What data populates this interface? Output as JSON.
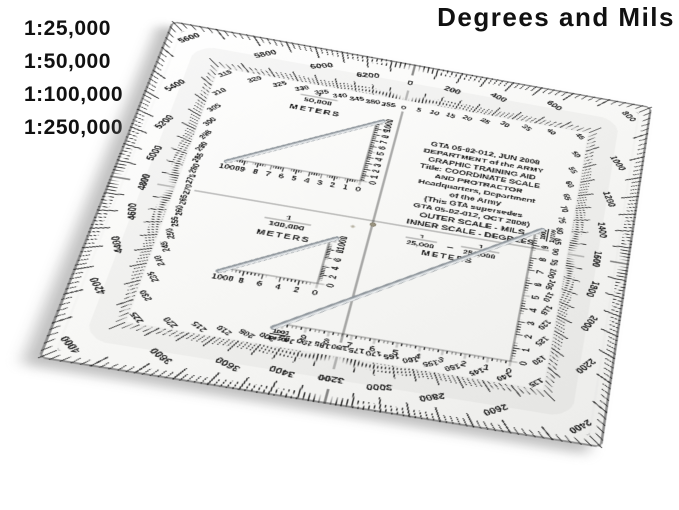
{
  "title": "Degrees and Mils",
  "ratios": {
    "items": [
      "1:25,000",
      "1:50,000",
      "1:100,000",
      "1:250,000"
    ]
  },
  "colors": {
    "ink": "#1a1a1a",
    "plastic_light": "#ffffff",
    "plastic_dark": "#ececea",
    "edge": "#8d8d8d",
    "rod_dark": "#8f969c",
    "rod_mid": "#c9ced2",
    "rod_light": "#f2f4f5",
    "hole": "#9a9480"
  },
  "protractor": {
    "info_block": {
      "lines": [
        "GTA 05-02-012, JUN 2008",
        "DEPARTMENT of the ARMY",
        "GRAPHIC TRAINING AID",
        "Title: COORDINATE SCALE",
        "AND PROTRACTOR",
        "Headquarters, Department",
        "of the Army",
        "(This GTA supersedes",
        "GTA 05-02-012, OCT 2008)"
      ]
    },
    "scale_note": {
      "line1": "OUTER SCALE - MILS",
      "line2": "INNER SCALE - DEGREES"
    },
    "center_fraction": {
      "num1": "1",
      "den1": "25,000",
      "dash": "–",
      "num2": "1",
      "den2": "250,000",
      "unit": "METERS"
    },
    "outer_scale": {
      "unit": "mils",
      "full_circle": 6400,
      "tick_step": 20,
      "major_step": 100,
      "label_step": 200,
      "labels": [
        "0",
        "200",
        "400",
        "600",
        "800",
        "1000",
        "1200",
        "1400",
        "1600",
        "1800",
        "2000",
        "2200",
        "2400",
        "2600",
        "2800",
        "3000",
        "3200",
        "3400",
        "3600",
        "3800",
        "4000",
        "4200",
        "4400",
        "4600",
        "4800",
        "5000",
        "5200",
        "5400",
        "5600",
        "5800",
        "6000",
        "6200"
      ]
    },
    "inner_scale": {
      "unit": "degrees",
      "full_circle": 360,
      "tick_step": 1,
      "label_step": 5,
      "labels": [
        "0",
        "5",
        "10",
        "15",
        "20",
        "25",
        "30",
        "35",
        "40",
        "45",
        "50",
        "55",
        "60",
        "65",
        "70",
        "75",
        "80",
        "85",
        "90",
        "95",
        "100",
        "105",
        "110",
        "115",
        "120",
        "125",
        "130",
        "135",
        "140",
        "145",
        "150",
        "155",
        "160",
        "165",
        "170",
        "175",
        "180",
        "185",
        "190",
        "195",
        "200",
        "205",
        "210",
        "215",
        "220",
        "225",
        "230",
        "235",
        "240",
        "245",
        "250",
        "255",
        "260",
        "265",
        "270",
        "275",
        "280",
        "285",
        "290",
        "295",
        "300",
        "305",
        "310",
        "315",
        "320",
        "325",
        "330",
        "335",
        "340",
        "345",
        "350",
        "355"
      ]
    },
    "triangles": [
      {
        "id": "50k",
        "label_num": "1",
        "label_den": "50,000",
        "label_unit": "METERS",
        "h_labels": [
          "1000",
          "9",
          "8",
          "7",
          "6",
          "5",
          "4",
          "3",
          "2",
          "1",
          "0"
        ],
        "v_labels": [
          "0",
          "1",
          "2",
          "3",
          "4",
          "5",
          "6",
          "7",
          "8",
          "9",
          "1000"
        ]
      },
      {
        "id": "100k",
        "label_num": "1",
        "label_den": "100,000",
        "label_unit": "METERS",
        "h_labels": [
          "1000",
          "8",
          "6",
          "4",
          "2",
          "0"
        ],
        "v_labels": [
          "0",
          "2",
          "4",
          "6",
          "8",
          "1000"
        ]
      },
      {
        "id": "25k-250k",
        "h_labels": [
          "1000|10000",
          "9",
          "8",
          "7",
          "6",
          "5",
          "4",
          "3",
          "2",
          "1",
          "0"
        ],
        "v_labels": [
          "0",
          "1",
          "2",
          "3",
          "4",
          "5",
          "6",
          "7",
          "8",
          "9",
          "1000|10000"
        ]
      }
    ]
  }
}
